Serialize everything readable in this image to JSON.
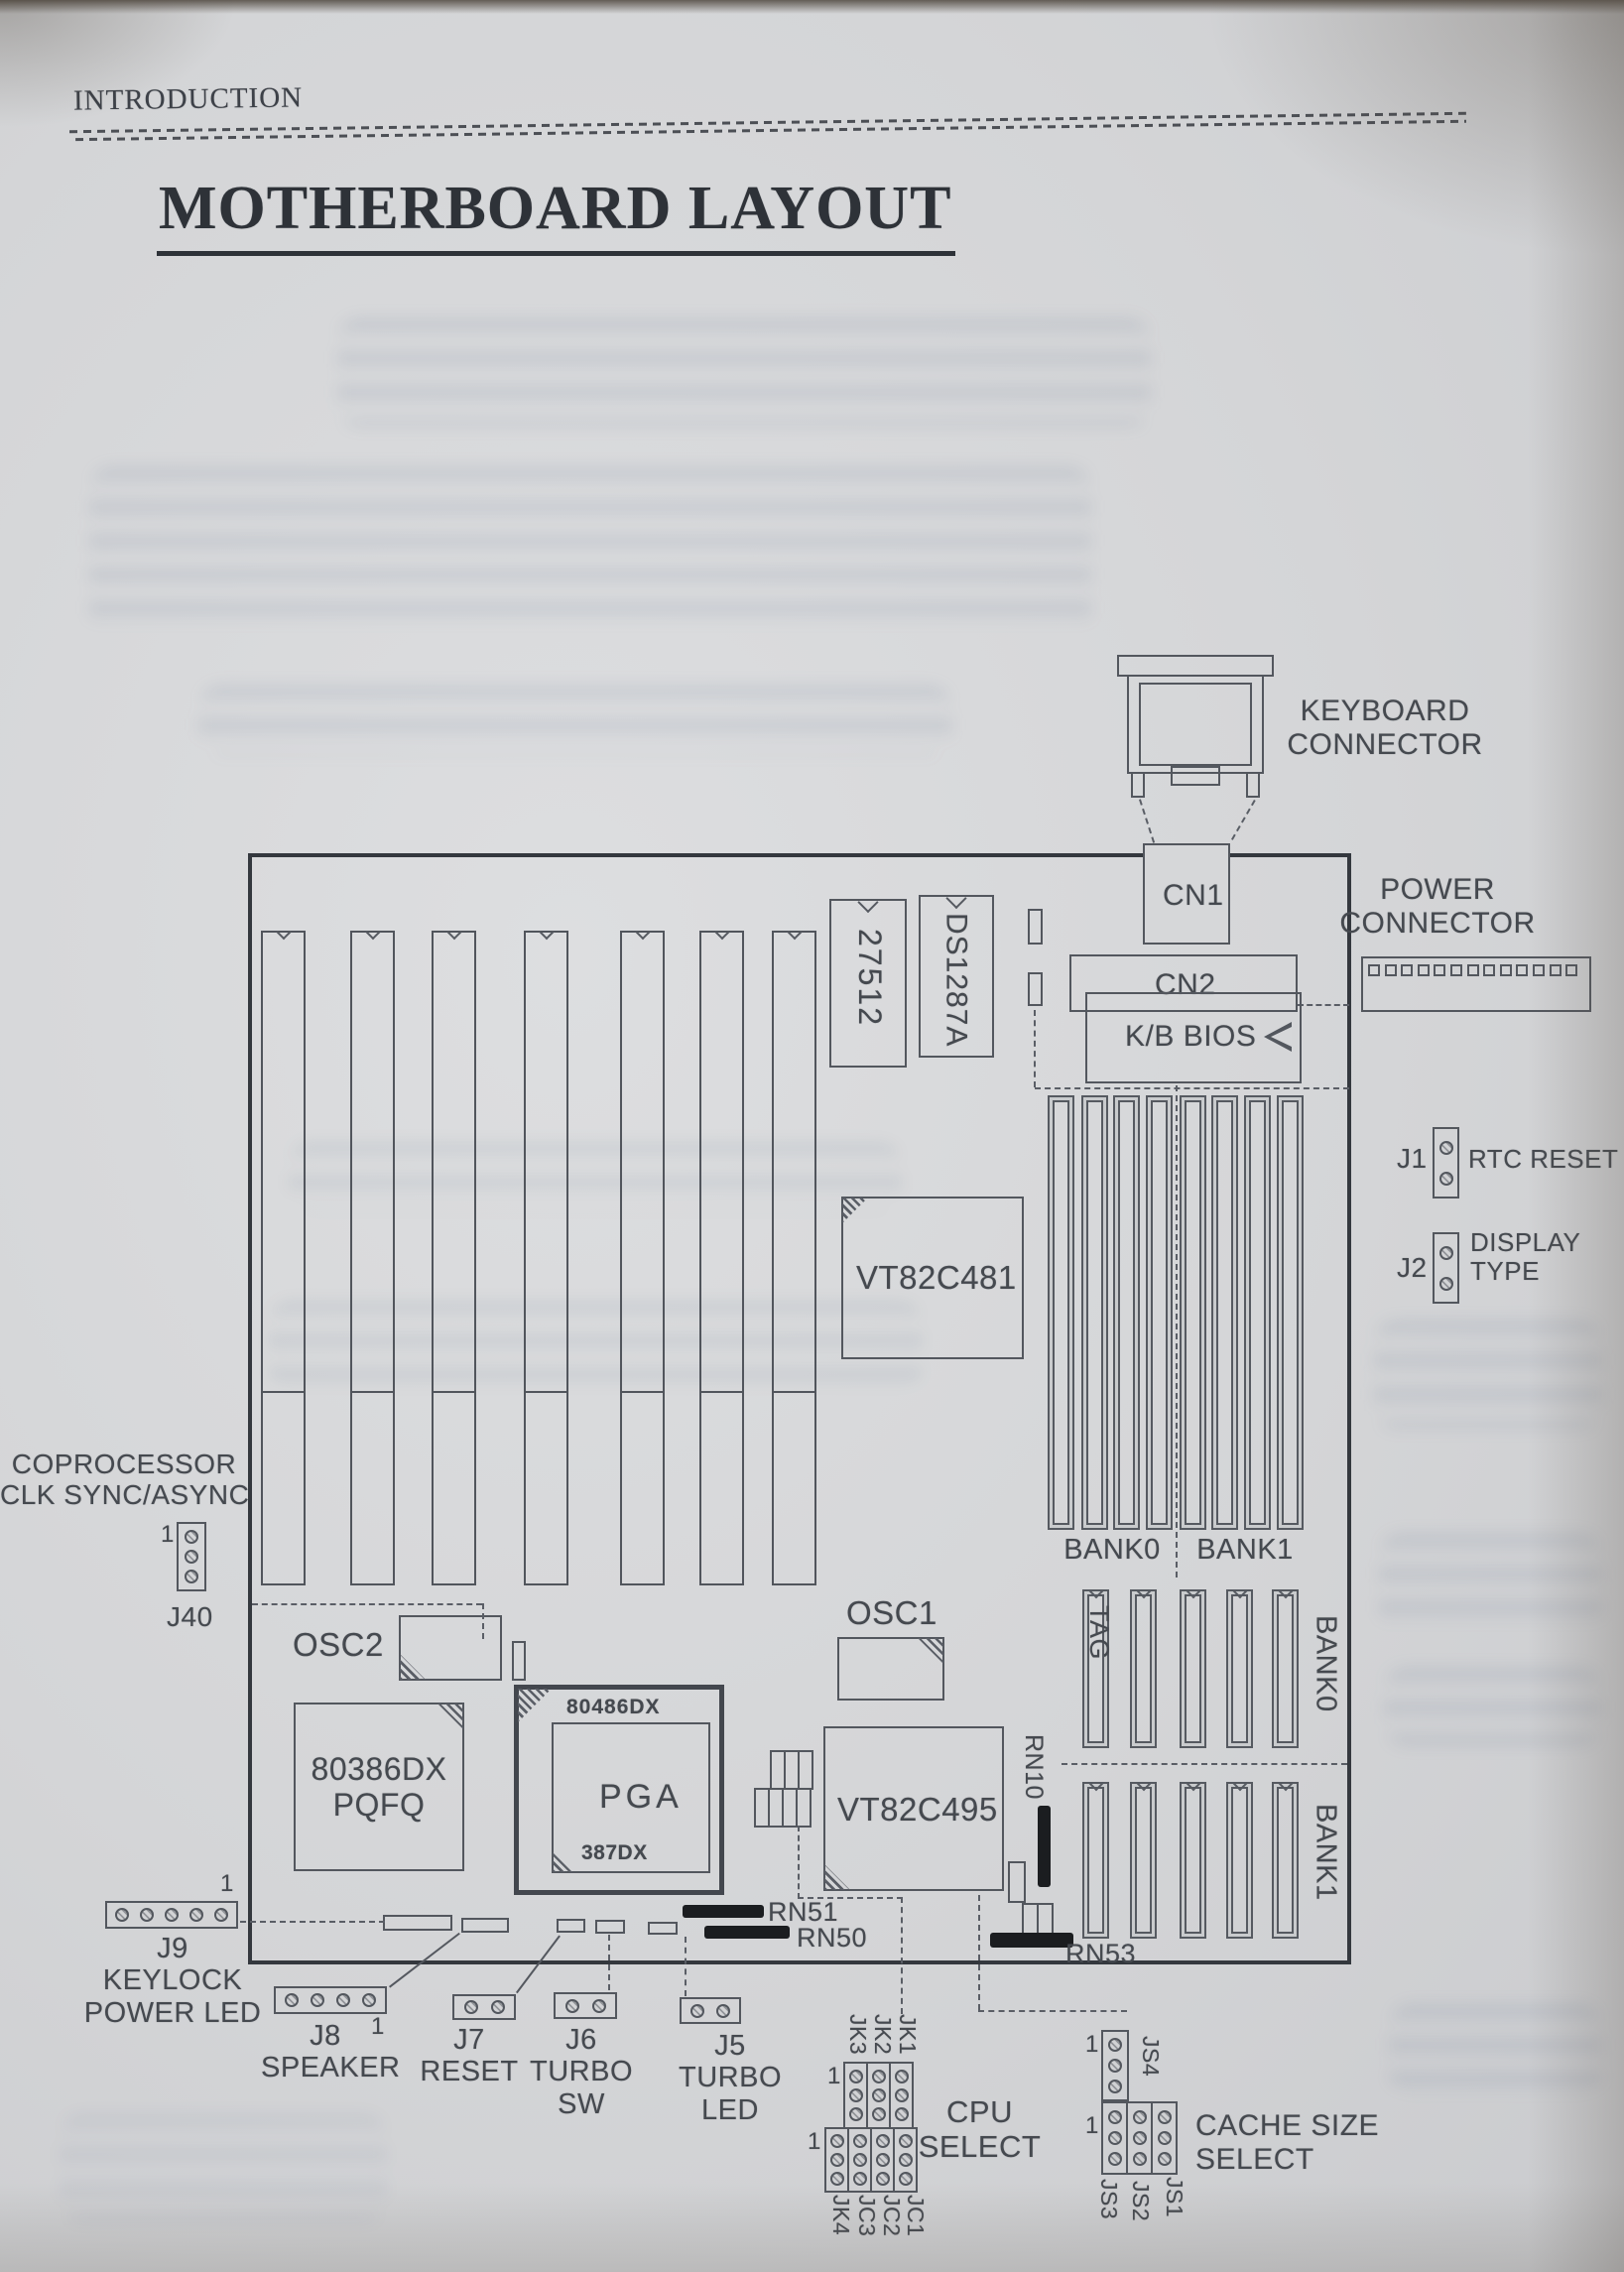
{
  "page": {
    "kicker": "INTRODUCTION",
    "title": "MOTHERBOARD LAYOUT"
  },
  "board": {
    "keyboard_connector": {
      "line1": "KEYBOARD",
      "line2": "CONNECTOR"
    },
    "power_connector": {
      "line1": "POWER",
      "line2": "CONNECTOR"
    },
    "cn1": "CN1",
    "cn2": "CN2",
    "kb_bios": "K/B BIOS",
    "rom_chip": "27512",
    "rtc_chip": "DS1287A",
    "chipset1": "VT82C481",
    "chipset2": "VT82C495",
    "osc1": "OSC1",
    "osc2": "OSC2",
    "cpu_pqfp": {
      "line1": "80386DX",
      "line2": "PQFQ"
    },
    "cpu_socket": {
      "top": "80486DX",
      "center": "PGA",
      "bottom": "387DX"
    },
    "simm": {
      "bank0": "BANK0",
      "bank1": "BANK1"
    },
    "cache": {
      "tag": "TAG",
      "bank0": "BANK0",
      "bank1": "BANK1"
    },
    "rn10": "RN10",
    "rn51": "RN51",
    "rn50": "RN50",
    "rn53": "RN53"
  },
  "jumpers": {
    "pin1": "1",
    "j1": {
      "name": "J1",
      "desc": "RTC RESET"
    },
    "j2": {
      "name": "J2",
      "desc1": "DISPLAY",
      "desc2": "TYPE"
    },
    "j40": {
      "name": "J40",
      "desc1": "COPROCESSOR",
      "desc2": "CLK SYNC/ASYNC"
    },
    "j9": {
      "name": "J9",
      "desc1": "KEYLOCK",
      "desc2": "POWER LED"
    },
    "j8": {
      "name": "J8",
      "desc": "SPEAKER"
    },
    "j7": {
      "name": "J7",
      "desc": "RESET"
    },
    "j6": {
      "name": "J6",
      "desc1": "TURBO",
      "desc2": "SW"
    },
    "j5": {
      "name": "J5",
      "desc1": "TURBO",
      "desc2": "LED"
    },
    "cpu_select": {
      "line1": "CPU",
      "line2": "SELECT",
      "top_labels": [
        "JK3",
        "JK2",
        "JK1"
      ],
      "bottom_labels": [
        "JK4",
        "JC3",
        "JC2",
        "JC1"
      ]
    },
    "cache_select": {
      "line1": "CACHE SIZE",
      "line2": "SELECT",
      "js4": "JS4",
      "bottom_labels": [
        "JS3",
        "JS2",
        "JS1"
      ]
    }
  }
}
